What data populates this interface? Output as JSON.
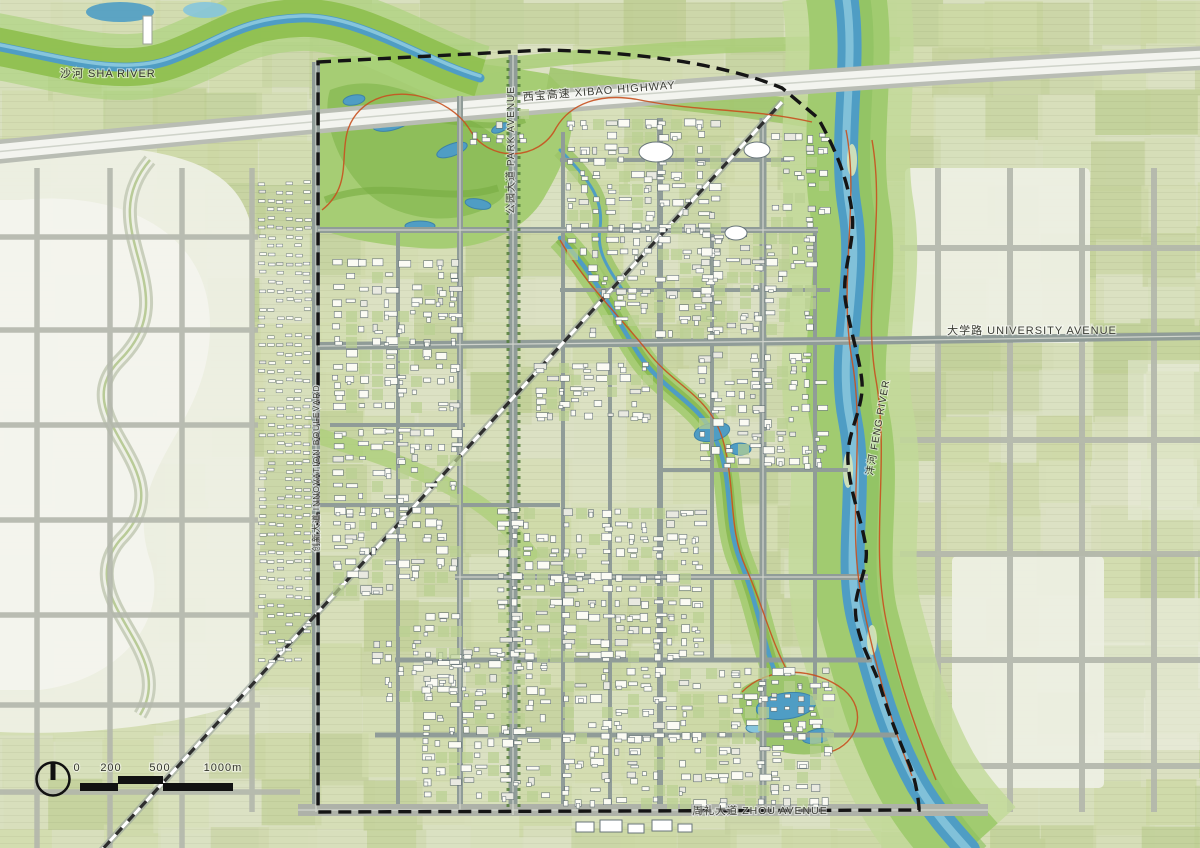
{
  "map": {
    "title": "Urban master plan",
    "labels": {
      "sha_river": "沙河 SHA RIVER",
      "xibao_highway": "西宝高速 XIBAO HIGHWAY",
      "park_avenue": "公园大道 PARK AVENUE",
      "innovation_boulevard": "创新大道 INNOVATION BOULEVARD",
      "university_avenue": "大学路 UNIVERSITY AVENUE",
      "feng_river": "沣河 FENG RIVER",
      "zhou_avenue": "周礼大道 ZHOU AVENUE"
    },
    "scale_bar": {
      "ticks": [
        "0",
        "200",
        "500",
        "1000m"
      ]
    },
    "colors": {
      "field_base": "#d4dcb2",
      "field_alt": "#c4d19c",
      "pale_land": "#edefe3",
      "park_green": "#8cbd58",
      "park_light": "#a6cd74",
      "water": "#4f9dc4",
      "water_light": "#86c5dc",
      "road_gray": "#a8aca3",
      "street_gray": "#909c98",
      "highway_white": "#f3f4ef",
      "building_fill": "#fbfbf4",
      "building_stroke": "#5d6b70",
      "boundary_black": "#151515",
      "trail_red": "#c8511f",
      "rail_black": "#2e2e2e"
    }
  }
}
